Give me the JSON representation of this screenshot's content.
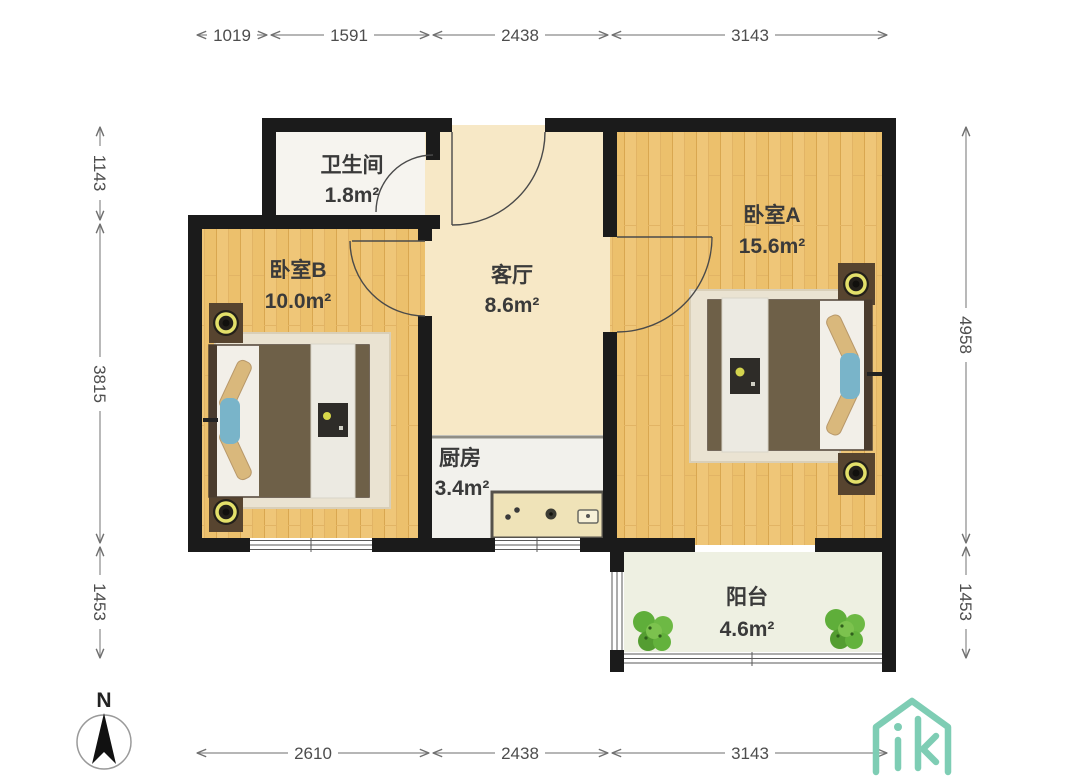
{
  "plan": {
    "title": "apartment-floorplan",
    "rooms": {
      "bathroom": {
        "name": "卫生间",
        "area": "1.8m²"
      },
      "living_room": {
        "name": "客厅",
        "area": "8.6m²"
      },
      "kitchen": {
        "name": "厨房",
        "area": "3.4m²"
      },
      "bedroom_a": {
        "name": "卧室A",
        "area": "15.6m²"
      },
      "bedroom_b": {
        "name": "卧室B",
        "area": "10.0m²"
      },
      "balcony": {
        "name": "阳台",
        "area": "4.6m²"
      }
    },
    "dimensions_mm": {
      "top": [
        "1019",
        "1591",
        "2438",
        "3143"
      ],
      "left": [
        "1143",
        "3815",
        "1453"
      ],
      "right": [
        "4958",
        "1453"
      ],
      "bottom": [
        "2610",
        "2438",
        "3143"
      ]
    },
    "compass": {
      "label": "N"
    },
    "colors": {
      "wall": "#1b1b1b",
      "wood_floor": "#efc678",
      "living_floor": "#f7e8c6",
      "kitchen_floor": "#f2f1ec",
      "bathroom_floor": "#f6f4ef",
      "balcony_floor": "#eef0e2",
      "logo_green": "#7ecdb4",
      "plant_green": "#64b23c",
      "accent_teal": "#79b4c9"
    }
  }
}
